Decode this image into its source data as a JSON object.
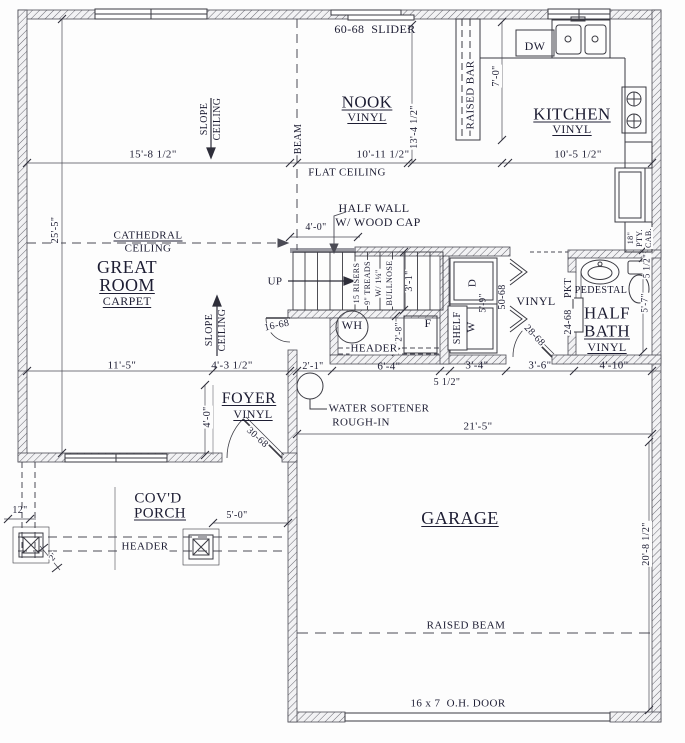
{
  "colors": {
    "ink": "#1d1d33",
    "line": "#4b4b55",
    "wall_hatch": "#6a6a72"
  },
  "labels": [
    {
      "name": "slider-door-label",
      "text": "60-68  SLIDER",
      "x": 375,
      "y": 29,
      "fs": 12
    },
    {
      "name": "room-nook",
      "text": "NOOK",
      "x": 367,
      "y": 102,
      "fs": 17,
      "u": true
    },
    {
      "name": "nook-floor",
      "text": "VINYL",
      "x": 367,
      "y": 117,
      "fs": 12,
      "u": true
    },
    {
      "name": "raised-bar-label",
      "text": "RAISED BAR",
      "x": 471,
      "y": 95,
      "rot": -90,
      "fs": 11,
      "bg": true
    },
    {
      "name": "dishwasher-label",
      "text": "DW",
      "x": 535,
      "y": 46,
      "fs": 12
    },
    {
      "name": "dim-bar-height",
      "text": "7'-0\"",
      "x": 497,
      "y": 76,
      "rot": -90,
      "fs": 10,
      "bg": true
    },
    {
      "name": "room-kitchen",
      "text": "KITCHEN",
      "x": 572,
      "y": 114,
      "fs": 17,
      "u": true
    },
    {
      "name": "kitchen-floor",
      "text": "VINYL",
      "x": 572,
      "y": 129,
      "fs": 12,
      "u": true
    },
    {
      "name": "dim-kitchen-width",
      "text": "10'-5 1/2\"",
      "x": 578,
      "y": 155,
      "fs": 11
    },
    {
      "name": "dim-nook-width",
      "text": "10'-11 1/2\"",
      "x": 383,
      "y": 155,
      "fs": 11
    },
    {
      "name": "dim-nook-depth",
      "text": "13'-4 1/2\"",
      "x": 415,
      "y": 127,
      "rot": -90,
      "fs": 10,
      "bg": true
    },
    {
      "name": "dim-greatroom-width",
      "text": "15'-8 1/2\"",
      "x": 153,
      "y": 155,
      "fs": 11
    },
    {
      "name": "slope-ceiling-top-1",
      "text": "SLOPE",
      "x": 205,
      "y": 119,
      "rot": -90,
      "fs": 10
    },
    {
      "name": "slope-ceiling-top-2",
      "text": "CEILING",
      "x": 218,
      "y": 119,
      "rot": -90,
      "fs": 10
    },
    {
      "name": "beam-label",
      "text": "BEAM",
      "x": 299,
      "y": 139,
      "rot": -90,
      "fs": 10,
      "bg": true
    },
    {
      "name": "flat-ceiling-label",
      "text": "FLAT CEILING",
      "x": 347,
      "y": 173,
      "fs": 11
    },
    {
      "name": "cathedral-ceiling-1",
      "text": "CATHEDRAL",
      "x": 148,
      "y": 236,
      "fs": 11,
      "u": true,
      "bg": true
    },
    {
      "name": "cathedral-ceiling-2",
      "text": "CEILING",
      "x": 148,
      "y": 249,
      "fs": 11,
      "bg": true
    },
    {
      "name": "dim-greatroom-depth",
      "text": "25'-5\"",
      "x": 56,
      "y": 230,
      "rot": -90,
      "fs": 10,
      "bg": true
    },
    {
      "name": "half-wall-note-1",
      "text": "HALF WALL",
      "x": 374,
      "y": 208,
      "fs": 12
    },
    {
      "name": "half-wall-note-2",
      "text": "W/ WOOD CAP",
      "x": 378,
      "y": 222,
      "fs": 12
    },
    {
      "name": "dim-half-wall",
      "text": "4'-0\"",
      "x": 316,
      "y": 228,
      "fs": 10
    },
    {
      "name": "room-great-1",
      "text": "GREAT",
      "x": 127,
      "y": 267,
      "fs": 18
    },
    {
      "name": "room-great-2",
      "text": "ROOM",
      "x": 127,
      "y": 285,
      "fs": 18,
      "u": true
    },
    {
      "name": "greatroom-floor",
      "text": "CARPET",
      "x": 127,
      "y": 301,
      "fs": 12,
      "u": true
    },
    {
      "name": "stairs-up-label",
      "text": "UP",
      "x": 275,
      "y": 282,
      "fs": 11
    },
    {
      "name": "stairs-note-1",
      "text": "15 RISERS",
      "x": 357,
      "y": 283,
      "rot": -90,
      "fs": 8,
      "bg": true
    },
    {
      "name": "stairs-note-2",
      "text": "9\" TREADS",
      "x": 368,
      "y": 283,
      "rot": -90,
      "fs": 8,
      "bg": true
    },
    {
      "name": "stairs-note-3",
      "text": "W/ 1¼\"",
      "x": 379,
      "y": 283,
      "rot": -90,
      "fs": 8,
      "bg": true
    },
    {
      "name": "stairs-note-4",
      "text": "BULLNOSE",
      "x": 390,
      "y": 283,
      "rot": -90,
      "fs": 8,
      "bg": true
    },
    {
      "name": "dim-stair-width",
      "text": "3'-1\"",
      "x": 410,
      "y": 281,
      "rot": -90,
      "fs": 10,
      "bg": true
    },
    {
      "name": "slope-ceiling-bottom-1",
      "text": "SLOPE",
      "x": 210,
      "y": 330,
      "rot": -90,
      "fs": 10
    },
    {
      "name": "slope-ceiling-bottom-2",
      "text": "CEILING",
      "x": 223,
      "y": 330,
      "rot": -90,
      "fs": 10
    },
    {
      "name": "door-16-68",
      "text": "16-68",
      "x": 277,
      "y": 326,
      "rot": -12,
      "fs": 10,
      "bg": true
    },
    {
      "name": "water-heater-label",
      "text": "WH",
      "x": 352,
      "y": 325,
      "fs": 12
    },
    {
      "name": "closet-header-label",
      "text": "HEADER",
      "x": 374,
      "y": 349,
      "fs": 11,
      "bg": true
    },
    {
      "name": "dim-closet",
      "text": "2'-8\"",
      "x": 399,
      "y": 332,
      "rot": -90,
      "fs": 9,
      "bg": true
    },
    {
      "name": "furnace-label",
      "text": "F",
      "x": 428,
      "y": 323,
      "fs": 12
    },
    {
      "name": "shelf-label",
      "text": "SHELF",
      "x": 458,
      "y": 328,
      "rot": -90,
      "fs": 10,
      "bg": true
    },
    {
      "name": "dryer-label",
      "text": "D",
      "x": 473,
      "y": 283,
      "rot": -90,
      "fs": 11
    },
    {
      "name": "dim-laundry",
      "text": "5'-9\"",
      "x": 483,
      "y": 303,
      "rot": -90,
      "fs": 9
    },
    {
      "name": "washer-label",
      "text": "W",
      "x": 472,
      "y": 327,
      "rot": -90,
      "fs": 11
    },
    {
      "name": "door-50-68",
      "text": "50-68",
      "x": 503,
      "y": 297,
      "rot": -90,
      "fs": 10,
      "bg": true
    },
    {
      "name": "hall-floor",
      "text": "VINYL",
      "x": 536,
      "y": 301,
      "fs": 12
    },
    {
      "name": "door-28-68",
      "text": "28-68",
      "x": 534,
      "y": 336,
      "rot": 47,
      "fs": 10,
      "bg": true
    },
    {
      "name": "pocket-door-label-1",
      "text": "PKT",
      "x": 569,
      "y": 288,
      "rot": -90,
      "fs": 10,
      "bg": true
    },
    {
      "name": "pocket-door-label-2",
      "text": "24-68",
      "x": 569,
      "y": 322,
      "rot": -90,
      "fs": 10,
      "bg": true
    },
    {
      "name": "pedestal-sink-label",
      "text": "PEDESTAL",
      "x": 601,
      "y": 291,
      "fs": 10
    },
    {
      "name": "room-halfbath-1",
      "text": "HALF",
      "x": 607,
      "y": 313,
      "fs": 17
    },
    {
      "name": "room-halfbath-2",
      "text": "BATH",
      "x": 607,
      "y": 331,
      "fs": 17,
      "u": true
    },
    {
      "name": "halfbath-floor",
      "text": "VINYL",
      "x": 607,
      "y": 347,
      "fs": 12,
      "u": true
    },
    {
      "name": "dim-halfbath-wall",
      "text": "5 1/2\"",
      "x": 647,
      "y": 266,
      "rot": -90,
      "fs": 9,
      "bg": true
    },
    {
      "name": "dim-halfbath-depth",
      "text": "5'-7\"",
      "x": 645,
      "y": 303,
      "rot": -90,
      "fs": 9,
      "bg": true
    },
    {
      "name": "pantry-cab-1",
      "text": "18\"",
      "x": 631,
      "y": 238,
      "rot": -90,
      "fs": 8,
      "bg": true
    },
    {
      "name": "pantry-cab-2",
      "text": "PTY.",
      "x": 640,
      "y": 238,
      "rot": -90,
      "fs": 8,
      "bg": true
    },
    {
      "name": "pantry-cab-3",
      "text": "CAB.",
      "x": 649,
      "y": 238,
      "rot": -90,
      "fs": 8,
      "bg": true
    },
    {
      "name": "dim-greatroom-front",
      "text": "11'-5\"",
      "x": 122,
      "y": 366,
      "fs": 11
    },
    {
      "name": "dim-foyer-width",
      "text": "4'-3 1/2\"",
      "x": 232,
      "y": 366,
      "fs": 11
    },
    {
      "name": "dim-passage",
      "text": "2'-1\"",
      "x": 313,
      "y": 367,
      "fs": 10
    },
    {
      "name": "dim-closet-width",
      "text": "6'-4\"",
      "x": 389,
      "y": 367,
      "fs": 11
    },
    {
      "name": "dim-wall-thickness",
      "text": "5 1/2\"",
      "x": 447,
      "y": 383,
      "fs": 10
    },
    {
      "name": "dim-laundry-width",
      "text": "3'-4\"",
      "x": 477,
      "y": 366,
      "fs": 11
    },
    {
      "name": "dim-hall-width",
      "text": "3'-6\"",
      "x": 540,
      "y": 366,
      "fs": 11
    },
    {
      "name": "dim-halfbath-width",
      "text": "4'-10\"",
      "x": 614,
      "y": 366,
      "fs": 11
    },
    {
      "name": "dim-foyer-depth",
      "text": "4'-0\"",
      "x": 208,
      "y": 417,
      "rot": -90,
      "fs": 10,
      "bg": true
    },
    {
      "name": "room-foyer",
      "text": "FOYER",
      "x": 249,
      "y": 399,
      "fs": 16,
      "u": true
    },
    {
      "name": "foyer-floor",
      "text": "VINYL",
      "x": 253,
      "y": 414,
      "fs": 12,
      "u": true
    },
    {
      "name": "door-30-68",
      "text": "30-68",
      "x": 257,
      "y": 438,
      "rot": 42,
      "fs": 10,
      "bg": true
    },
    {
      "name": "water-softener-note-1",
      "text": "WATER SOFTENER",
      "x": 379,
      "y": 409,
      "fs": 11
    },
    {
      "name": "water-softener-note-2",
      "text": "ROUGH-IN",
      "x": 361,
      "y": 423,
      "fs": 11
    },
    {
      "name": "dim-garage-width",
      "text": "21'-5\"",
      "x": 478,
      "y": 427,
      "fs": 11
    },
    {
      "name": "room-porch-1",
      "text": "COV'D",
      "x": 158,
      "y": 499,
      "fs": 15
    },
    {
      "name": "room-porch-2",
      "text": "PORCH",
      "x": 160,
      "y": 514,
      "fs": 15,
      "u": true
    },
    {
      "name": "dim-porch",
      "text": "5'-0\"",
      "x": 237,
      "y": 516,
      "fs": 10
    },
    {
      "name": "dim-post",
      "text": "12\"",
      "x": 20,
      "y": 511,
      "fs": 10
    },
    {
      "name": "porch-header-label",
      "text": "HEADER",
      "x": 145,
      "y": 547,
      "fs": 11,
      "bg": true
    },
    {
      "name": "dim-post-offset",
      "text": "2'",
      "x": 53,
      "y": 557,
      "rot": -50,
      "fs": 9,
      "bg": true
    },
    {
      "name": "room-garage",
      "text": "GARAGE",
      "x": 460,
      "y": 518,
      "fs": 18,
      "u": true
    },
    {
      "name": "dim-garage-depth",
      "text": "20'-8 1/2\"",
      "x": 647,
      "y": 544,
      "rot": -90,
      "fs": 10,
      "bg": true
    },
    {
      "name": "raised-beam-label",
      "text": "RAISED BEAM",
      "x": 466,
      "y": 626,
      "fs": 11,
      "bg": true
    },
    {
      "name": "overhead-door-label",
      "text": "16 x 7  O.H. DOOR",
      "x": 458,
      "y": 704,
      "fs": 11
    }
  ]
}
